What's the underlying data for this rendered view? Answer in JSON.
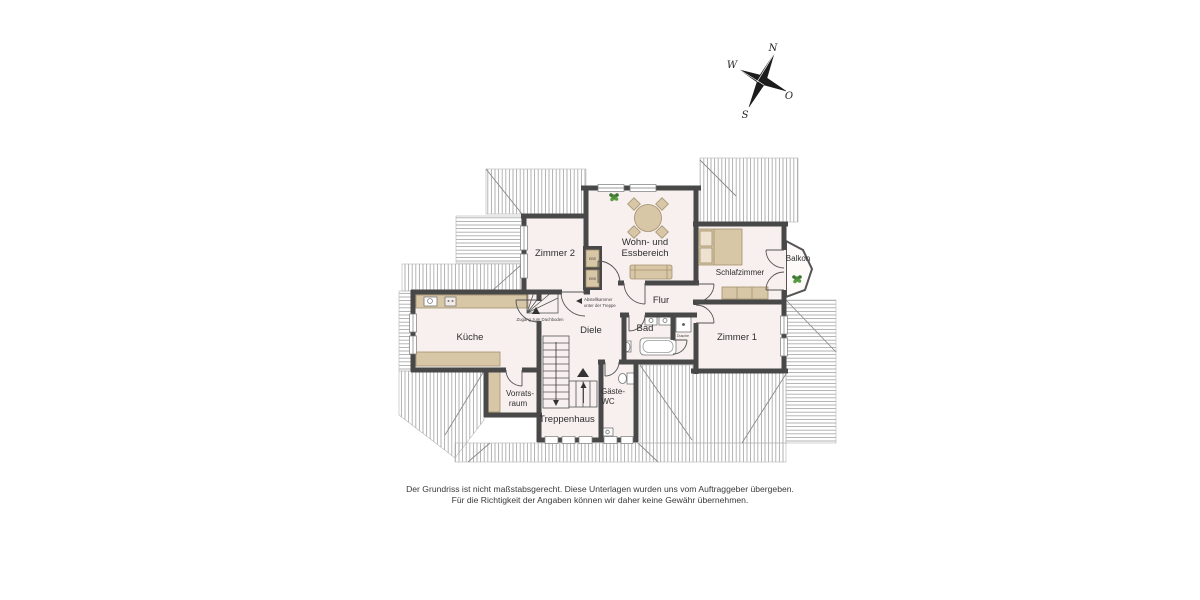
{
  "compass": {
    "n": "N",
    "o": "O",
    "s": "S",
    "w": "W"
  },
  "rooms": {
    "zimmer2": "Zimmer 2",
    "wohn_line1": "Wohn- und",
    "wohn_line2": "Essbereich",
    "schlafzimmer": "Schlafzimmer",
    "balkon": "Balkon",
    "kueche": "Küche",
    "flur": "Flur",
    "bad": "Bad",
    "dusche": "Dusche",
    "zimmer1": "Zimmer 1",
    "diele": "Diele",
    "vorrat_line1": "Vorrats-",
    "vorrat_line2": "raum",
    "wc_line1": "Gäste-",
    "wc_line2": "WC",
    "treppenhaus": "Treppenhaus"
  },
  "annotations": {
    "abstell_line1": "Abstellkammer",
    "abstell_line2": "unter der Treppe",
    "zugang": "Zugang zum Dachboden",
    "ebs": "EBS"
  },
  "disclaimer": {
    "line1": "Der Grundriss ist nicht maßstabsgerecht. Diese Unterlagen wurden uns vom Auftraggeber übergeben.",
    "line2": "Für die Richtigkeit der Angaben können wir daher keine Gewähr übernehmen."
  },
  "colors": {
    "wall": "#484848",
    "floor": "#f8f0ef",
    "furniture": "#d8c7a6",
    "furniture_border": "#a3906c",
    "hatch_line": "#9a9a9a",
    "plant_green": "#4a8a3a"
  }
}
